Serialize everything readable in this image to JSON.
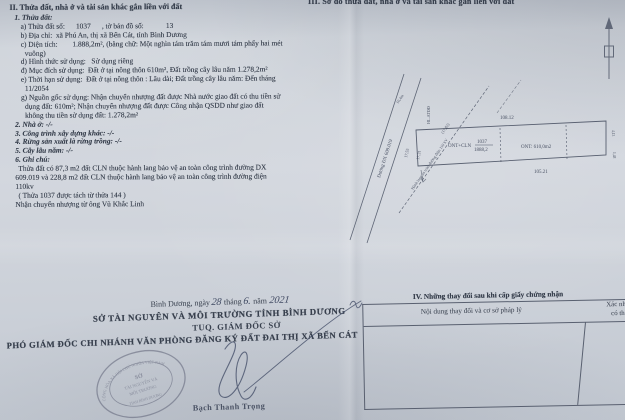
{
  "palette": {
    "paper": "#ced3da",
    "ink": "#38404e",
    "seal_ink": "#5e6277",
    "signature_ink": "#46506a"
  },
  "section2": {
    "heading": "II. Thửa đất, nhà ở và tài sản khác gắn liền với đất",
    "lines": [
      "1. Thửa đất:",
      "a) Thửa đất số:      1037      , tờ bản đồ số:            13",
      "b) Địa chỉ:  xã Phú An, thị xã Bến Cát, tỉnh Bình Dương",
      "c) Diện tích:        1.888,2m², (bằng chữ: Một nghìn tám trăm tám mươi tám phẩy hai mét",
      "vuông)",
      "d) Hình thức sử dụng:   Sử dụng riêng",
      "đ) Mục đích sử dụng:  Đất ở tại nông thôn 610m², Đất trồng cây lâu năm 1.278,2m²",
      "e) Thời hạn sử dụng:  Đất ở tại nông thôn : Lâu dài; Đất trồng cây lâu năm: Đến tháng",
      "11/2054",
      "g) Nguồn gốc sử dụng: Nhận chuyển nhượng đất được Nhà nước giao đất có thu tiền sử",
      "dụng đất: 610m²; Nhận chuyển nhượng đất được Công nhận QSDD như giao đất",
      "không thu tiền sử dụng đất: 1.278,2m²",
      "2. Nhà ở: -/-",
      "3. Công trình xây dựng khác: -/-",
      "4. Rừng sản xuất là rừng trồng: -/-",
      "5. Cây lâu năm: -/-",
      "6. Ghi chú:",
      "Thửa đất có 87,3 m2 đất CLN thuộc hành lang bảo vệ an toàn công trình đường DX",
      "609.019 và 228,8 m2 đất CLN thuộc hành lang bảo vệ an toàn công trình đường điện",
      "110kv",
      "( Thửa 1037 được tách từ thửa 144 )",
      "Nhận chuyển nhượng từ ông Vũ Khắc Linh"
    ]
  },
  "section3": {
    "heading": "III. Sơ đồ thửa đất, nhà ở và tài sản khác gắn liền với đất"
  },
  "diagram": {
    "road_label": "Đường ĐX 609.019",
    "power_line_label": "Hành lang an toàn đường điện 110 kV",
    "hl_atdd": "HL.ATĐĐ",
    "dim_top": "108.12",
    "dim_bottom": "105.21",
    "dim_left_1": "17,55",
    "dim_left_2": "17,31",
    "dim_left_3": "(17,82)",
    "dim_small_top": "10,4m",
    "dim_right_1": "4,13",
    "dim_right_2": "1,48",
    "parcel_use": "ONT+CLN",
    "parcel_number": "1037",
    "parcel_area": "1888,2",
    "ont_label": "ONT: 610,0m2"
  },
  "signing": {
    "date_prefix": "Bình Dương, ngày",
    "date_day": "28",
    "date_mid1": "tháng",
    "date_month": "6.",
    "date_mid2": "năm",
    "date_year": "2021",
    "org": "SỞ TÀI NGUYÊN VÀ MÔI TRƯỜNG TỈNH BÌNH DƯƠNG",
    "title_line": "TUQ. GIÁM ĐỐC SỞ",
    "deputy_line": "PHÓ GIÁM ĐỐC CHI NHÁNH VĂN PHÒNG ĐĂNG KÝ ĐẤT ĐAI THỊ XÃ BẾN CÁT",
    "signer_name": "Bạch Thanh Trọng",
    "seal": {
      "ring_top": "CỘNG HÒA XÃ HỘI CHỦ NGHĨA VIỆT NAM",
      "center1": "SỞ",
      "center2": "TÀI NGUYÊN VÀ",
      "center3": "MÔI TRƯỜNG",
      "ring_bottom": "TỈNH BÌNH DƯƠNG"
    }
  },
  "section4": {
    "title": "IV. Những thay đổi sau khi cấp giấy chứng nhận",
    "col1": "Nội dung thay đổi và cơ sở pháp lý",
    "col2_line1": "Xác nhận",
    "col2_line2": "có thẩ"
  }
}
